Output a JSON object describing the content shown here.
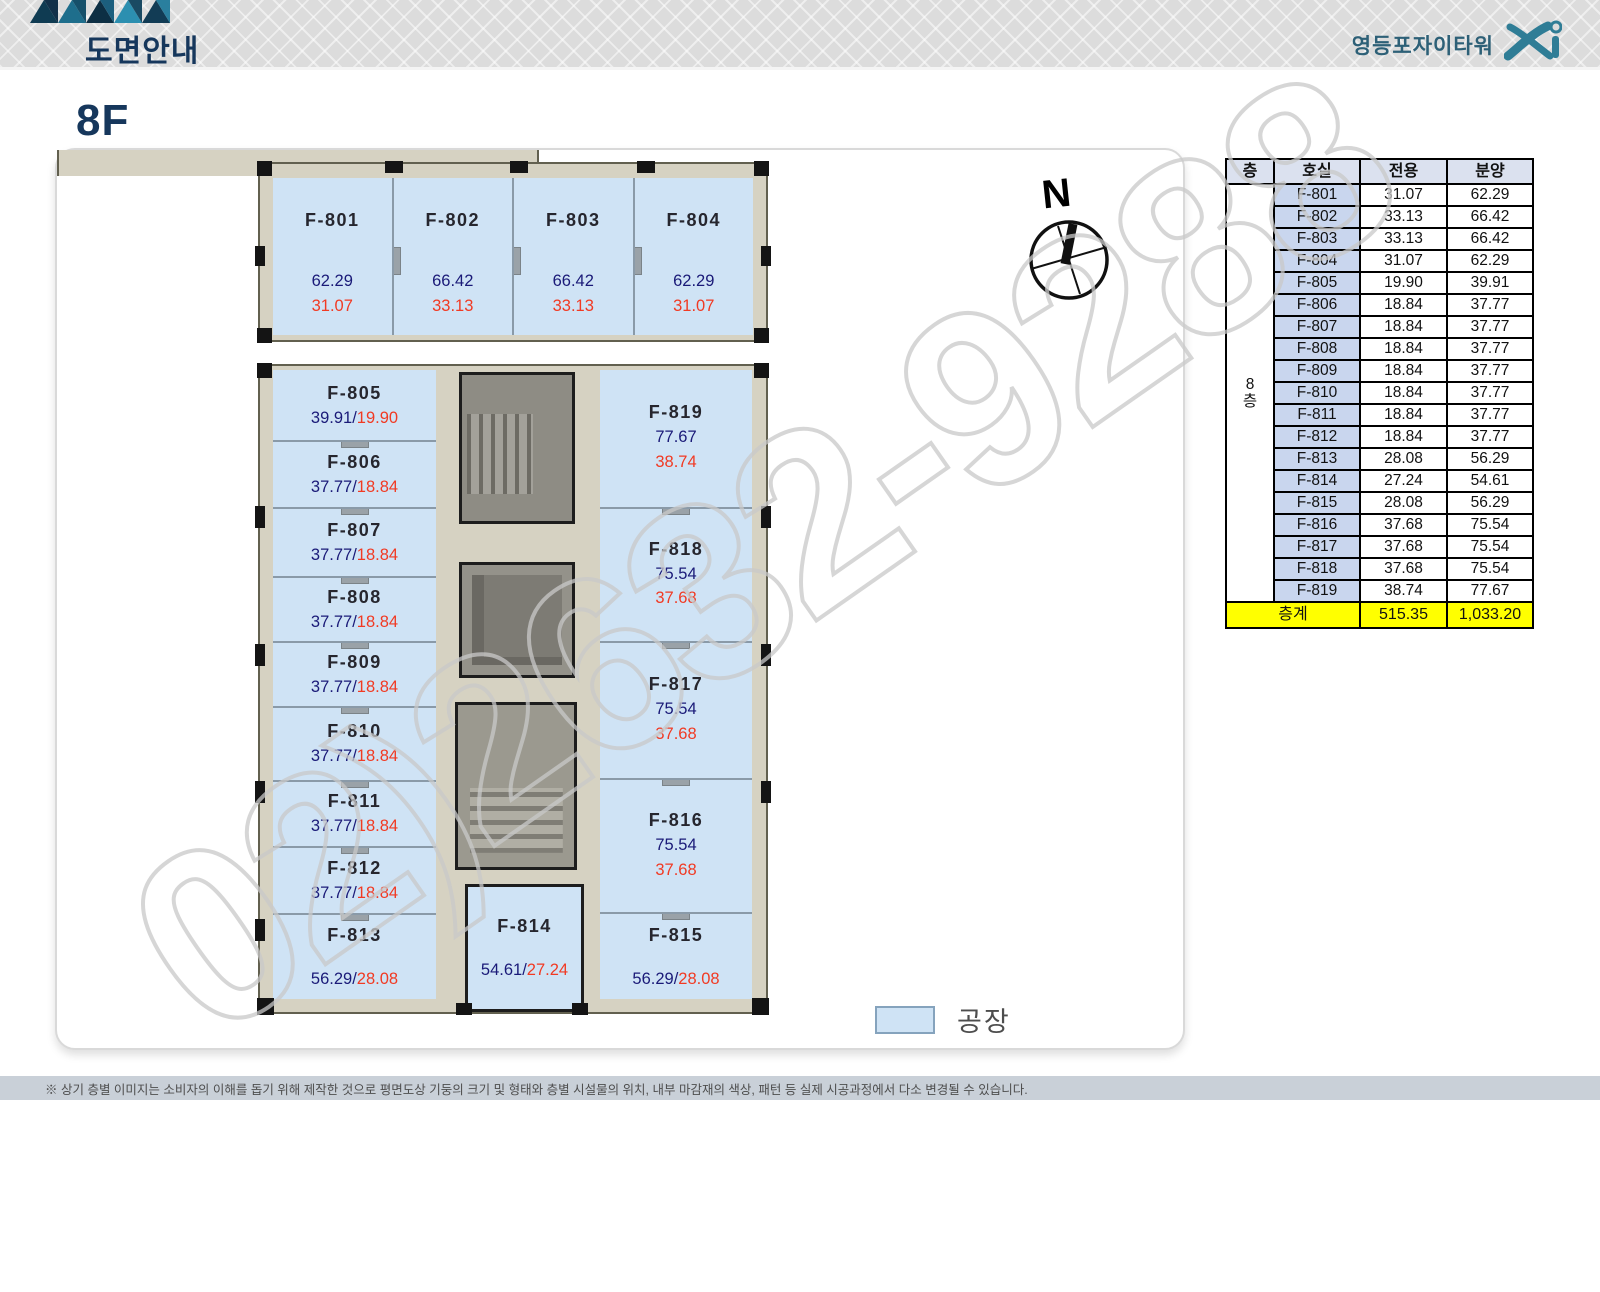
{
  "header": {
    "title": "도면안내",
    "brand": "영등포자이타워",
    "brand_mark": "Xi"
  },
  "page": {
    "floor_label": "8F"
  },
  "colors": {
    "unit_fill": "#cfe3f5",
    "sale_number": "#1a1a78",
    "exclusive_number": "#f13a23",
    "total_row": "#ffff00",
    "title_navy": "#16375c"
  },
  "plan": {
    "top_units": [
      {
        "name": "F-801",
        "sale": "62.29",
        "exclusive": "31.07"
      },
      {
        "name": "F-802",
        "sale": "66.42",
        "exclusive": "33.13"
      },
      {
        "name": "F-803",
        "sale": "66.42",
        "exclusive": "33.13"
      },
      {
        "name": "F-804",
        "sale": "62.29",
        "exclusive": "31.07"
      }
    ],
    "left_units": [
      {
        "name": "F-805",
        "sale": "39.91",
        "exclusive": "19.90"
      },
      {
        "name": "F-806",
        "sale": "37.77",
        "exclusive": "18.84"
      },
      {
        "name": "F-807",
        "sale": "37.77",
        "exclusive": "18.84"
      },
      {
        "name": "F-808",
        "sale": "37.77",
        "exclusive": "18.84"
      },
      {
        "name": "F-809",
        "sale": "37.77",
        "exclusive": "18.84"
      },
      {
        "name": "F-810",
        "sale": "37.77",
        "exclusive": "18.84"
      },
      {
        "name": "F-811",
        "sale": "37.77",
        "exclusive": "18.84"
      },
      {
        "name": "F-812",
        "sale": "37.77",
        "exclusive": "18.84"
      },
      {
        "name": "F-813",
        "sale": "56.29",
        "exclusive": "28.08"
      }
    ],
    "right_units": [
      {
        "name": "F-819",
        "sale": "77.67",
        "exclusive": "38.74"
      },
      {
        "name": "F-818",
        "sale": "75.54",
        "exclusive": "37.68"
      },
      {
        "name": "F-817",
        "sale": "75.54",
        "exclusive": "37.68"
      },
      {
        "name": "F-816",
        "sale": "75.54",
        "exclusive": "37.68"
      },
      {
        "name": "F-815",
        "sale": "56.29",
        "exclusive": "28.08"
      }
    ],
    "center_unit": {
      "name": "F-814",
      "sale": "54.61",
      "exclusive": "27.24"
    }
  },
  "compass": {
    "label": "N"
  },
  "legend": {
    "label": "공장"
  },
  "table": {
    "headers": [
      "층",
      "호실",
      "전용",
      "분양"
    ],
    "floor_cell": "8층",
    "rows": [
      [
        "F-801",
        "31.07",
        "62.29"
      ],
      [
        "F-802",
        "33.13",
        "66.42"
      ],
      [
        "F-803",
        "33.13",
        "66.42"
      ],
      [
        "F-804",
        "31.07",
        "62.29"
      ],
      [
        "F-805",
        "19.90",
        "39.91"
      ],
      [
        "F-806",
        "18.84",
        "37.77"
      ],
      [
        "F-807",
        "18.84",
        "37.77"
      ],
      [
        "F-808",
        "18.84",
        "37.77"
      ],
      [
        "F-809",
        "18.84",
        "37.77"
      ],
      [
        "F-810",
        "18.84",
        "37.77"
      ],
      [
        "F-811",
        "18.84",
        "37.77"
      ],
      [
        "F-812",
        "18.84",
        "37.77"
      ],
      [
        "F-813",
        "28.08",
        "56.29"
      ],
      [
        "F-814",
        "27.24",
        "54.61"
      ],
      [
        "F-815",
        "28.08",
        "56.29"
      ],
      [
        "F-816",
        "37.68",
        "75.54"
      ],
      [
        "F-817",
        "37.68",
        "75.54"
      ],
      [
        "F-818",
        "37.68",
        "75.54"
      ],
      [
        "F-819",
        "38.74",
        "77.67"
      ]
    ],
    "total": {
      "label": "층계",
      "exclusive": "515.35",
      "sale": "1,033.20"
    }
  },
  "watermark": "02)2632-9288",
  "footer": "※ 상기 층별 이미지는 소비자의 이해를 돕기 위해 제작한 것으로 평면도상 기둥의 크기 및 형태와 층별 시설물의 위치, 내부 마감재의 색상, 패턴 등 실제 시공과정에서 다소 변경될 수 있습니다."
}
